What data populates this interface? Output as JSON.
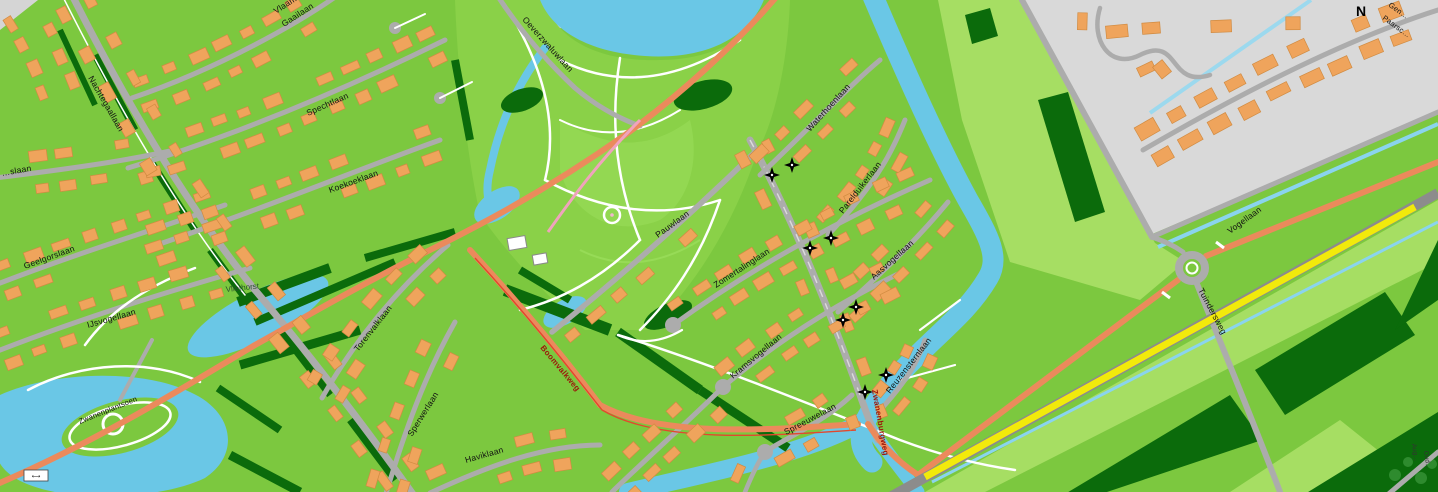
{
  "meta": {
    "type": "street-map",
    "style": "openstreetmap-like residential map",
    "viewport": "1438x492"
  },
  "colors": {
    "grass": "#7CC83F",
    "meadow": "#A6DE63",
    "forest": "#0B6B0B",
    "water": "#6AC7E6",
    "water_light": "#8AD4EE",
    "building": "#EFA45C",
    "building_outline": "#D18B41",
    "road_residential": "#ACACAC",
    "road_main_orange": "#EB8A5C",
    "road_secondary_yellow": "#F2EA0B",
    "urban_area": "#D9D9D9",
    "footpath": "#FFFFFF",
    "label_text": "#000000",
    "road_label_red": "#9C150A",
    "park": "#8AD148"
  },
  "street_labels": {
    "nachtegaallaan": "Nachtegaallaan",
    "vlaamse_gaailaan_line1": "Vlaamse",
    "vlaamse_gaailaan_line2": "Gaailaan",
    "spechtlaan": "Spechtlaan",
    "koekoeklaan": "Koekoeklaan",
    "left_edge_partial": "…slaan",
    "geelgorslaan": "Geelgorslaan",
    "ijsvogellaan": "IJsvogellaan",
    "zwanenplantsoen": "Zwanenplantsoen",
    "torenvalklaan": "Torenvalklaan",
    "sperwerlaan": "Sperwerlaan",
    "haviklaan": "Haviklaan",
    "boomvalkweg": "Boomvalkweg",
    "oeverzwaluwlaan": "Oeverzwaluwlaan",
    "pauwlaan": "Pauwlaan",
    "waterhoenlaan": "Waterhoenlaan",
    "parelduikerlaan": "Parelduikerlaan",
    "zomertalinglaan": "Zomertalinglaan",
    "aasvogellaan": "Aasvogellaan",
    "reuzensternlaan": "Reuzensternlaan",
    "kramsvogellaan": "Kramsvogellaan",
    "spreeuwelaan": "Spreeuwelaan",
    "zwanenburgweg": "Zwanenburgweg",
    "vogellaan": "Vogellaan",
    "tuindersweg": "Tuindersweg",
    "topright_line1": "Gen…",
    "topright_line2": "Paarsc…",
    "bottomright_line1": "Aug…",
    "bottomright_line2": "Oud…"
  },
  "area_labels": {
    "vliethorst": "Vliethorst",
    "north_letter": "N"
  },
  "markers": {
    "star_marker_count": 8,
    "star_marker_symbol": "four-pointed black star with white center"
  },
  "ui": {
    "scale_label": "⟷"
  }
}
